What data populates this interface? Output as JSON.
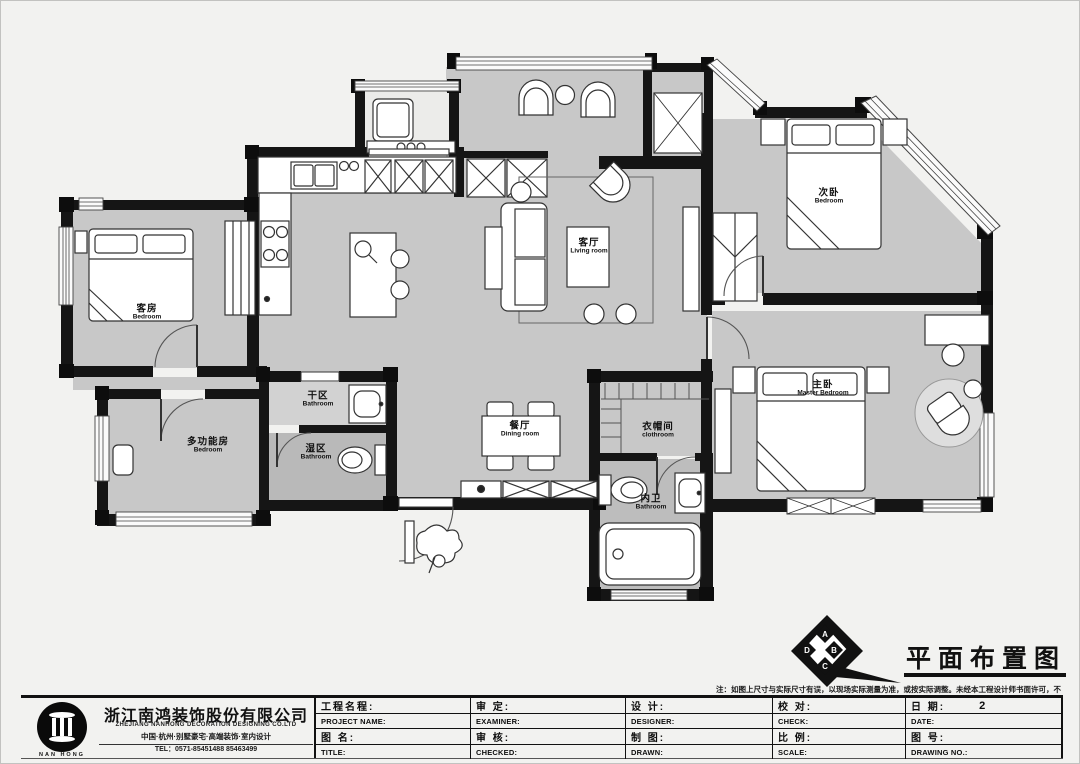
{
  "drawing": {
    "title": "平面布置图",
    "note": "注：如图上尺寸与实际尺寸有误，以现场实际测量为准，或按实际调整。未经本工程设计师书面许可，不得转借与私自分包。",
    "compass": {
      "a": "A",
      "b": "B",
      "c": "C",
      "d": "D"
    }
  },
  "colors": {
    "wall": "#151515",
    "floor": "#c8c8c8",
    "wet_floor": "#b9b9b9",
    "paper": "#f2f2f0"
  },
  "rooms": [
    {
      "id": "living-room",
      "cn": "客厅",
      "en": "Living room"
    },
    {
      "id": "dining-room",
      "cn": "餐厅",
      "en": "Dining room"
    },
    {
      "id": "guest-bedroom",
      "cn": "客房",
      "en": "Bedroom"
    },
    {
      "id": "second-bedroom",
      "cn": "次卧",
      "en": "Bedroom"
    },
    {
      "id": "master-bedroom",
      "cn": "主卧",
      "en": "Master Bedroom"
    },
    {
      "id": "multi-room",
      "cn": "多功能房",
      "en": "Bedroom"
    },
    {
      "id": "dry-bathroom",
      "cn": "干区",
      "en": "Bathroom"
    },
    {
      "id": "wet-bathroom",
      "cn": "湿区",
      "en": "Bathroom"
    },
    {
      "id": "cloakroom",
      "cn": "衣帽间",
      "en": "clothroom"
    },
    {
      "id": "inner-bathroom",
      "cn": "内卫",
      "en": "Bathroom"
    }
  ],
  "company": {
    "logo_text": "NAN HONG",
    "name": "浙江南鸿装饰股份有限公司",
    "name_en": "ZHEJIANG NANHONG DECORATION DESIGNING CO.LTD",
    "tagline": "中国·杭州·别墅豪宅·高端装饰·室内设计",
    "tel": "TEL：0571-85451488  85463499"
  },
  "titleblock": {
    "cells": [
      {
        "cn": "工程名程:",
        "en": "PROJECT NAME:",
        "value": ""
      },
      {
        "cn": "审  定:",
        "en": "EXAMINER:",
        "value": ""
      },
      {
        "cn": "设  计:",
        "en": "DESIGNER:",
        "value": ""
      },
      {
        "cn": "校  对:",
        "en": "CHECK:",
        "value": ""
      },
      {
        "cn": "日  期:",
        "en": "DATE:",
        "value": "2"
      },
      {
        "cn": "图  名:",
        "en": "TITLE:",
        "value": ""
      },
      {
        "cn": "审  核:",
        "en": "CHECKED:",
        "value": ""
      },
      {
        "cn": "制  图:",
        "en": "DRAWN:",
        "value": ""
      },
      {
        "cn": "比  例:",
        "en": "SCALE:",
        "value": ""
      },
      {
        "cn": "图  号:",
        "en": "DRAWING NO.:",
        "value": ""
      }
    ]
  }
}
